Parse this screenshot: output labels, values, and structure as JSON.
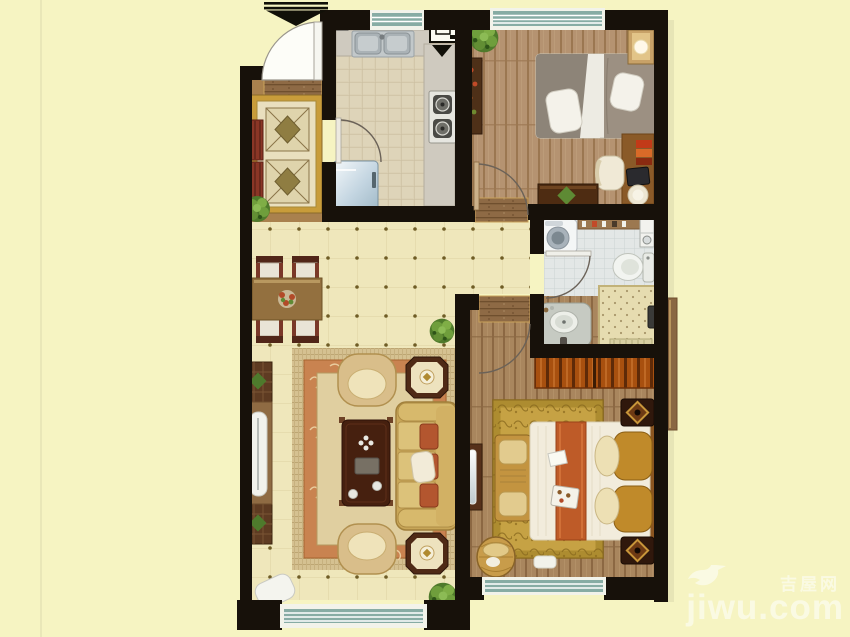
{
  "canvas": {
    "width": 850,
    "height": 637
  },
  "watermark": {
    "icon": "dove-bird-icon",
    "site_name_cn": "吉屋网",
    "logo_text": "jiwu.com"
  },
  "colors": {
    "bg": "#f6f4c2",
    "fold": "#e9e7b8",
    "wall": "#17110a",
    "glass": "#87aca4",
    "frame": "#f2f3ea",
    "tileLiving": "#efe7bb",
    "tileLivingLine": "#e1d5a6",
    "tileDot": "#6f5d26",
    "tileKitchen": "#dbd0b4",
    "tileKitchenLine": "#c8bc9e",
    "tileBath": "#e3e7e6",
    "tileBathLine": "#cbd3d3",
    "woodLight": "#b59371",
    "woodLightLine": "#9b7751",
    "woodMid": "#a9865e",
    "woodMidLine": "#8c6843",
    "thresh": "#8e6a45",
    "threshLine": "#6f4f2e",
    "counter": "#cfcabf",
    "steel": "#aab2b6",
    "fridge": "#c3d5e1",
    "rugGold": "#c6a244",
    "rugGoldBorder": "#ad8c30",
    "foyerRugBorder": "#c89c3a",
    "foyerRugField": "#e9dfbe",
    "fringe": "#d5c191",
    "rugOrange": "#c98350",
    "rugField": "#e0cfa0",
    "sofa": "#c8a658",
    "cushion": "#b3562f",
    "armchair": "#d9be8a",
    "woodFurn": "#8f6b43",
    "chairRed": "#7a3828",
    "wardrobe": "#a8500f",
    "bedWhite": "#f2ecdc",
    "runner": "#be5b28",
    "pillowGold": "#c08a2a",
    "plantGreen": "#4f7a2b",
    "wm": "#ffffff"
  },
  "floor_plan": {
    "style": "top-down rendered apartment floor plan, no text labels",
    "rooms": [
      {
        "name": "entry-foyer",
        "items": [
          "entrance-arrow-marker",
          "entry-door",
          "patterned-runner-rug",
          "shoe-cabinet-upper",
          "shoe-cabinet-lower",
          "potted-plant"
        ]
      },
      {
        "name": "kitchen",
        "items": [
          "window",
          "counter-top",
          "double-stainless-sink",
          "gas-meter-symbol",
          "flue-duct-symbol",
          "gas-stove-two-burners",
          "refrigerator",
          "kitchen-door"
        ]
      },
      {
        "name": "second-bedroom",
        "items": [
          "window",
          "potted-plant",
          "wall-shelf",
          "single-bed",
          "pillows",
          "corner-wardrobe-lamp",
          "desk",
          "books",
          "laptop",
          "stool",
          "chair",
          "low-table-with-plant",
          "room-door"
        ]
      },
      {
        "name": "bathroom",
        "items": [
          "washing-machine",
          "toiletry-shelf",
          "corner-washbasin-unit",
          "toilet",
          "vanity-sink",
          "shower-mat",
          "shower-fixture",
          "floor-drain",
          "bathroom-door"
        ]
      },
      {
        "name": "living-dining-room",
        "items": [
          "dining-table",
          "dining-chairs-x4",
          "flower-centerpiece",
          "tv-cabinet",
          "tv",
          "media-side-units",
          "area-rug",
          "armchair-north",
          "armchair-south",
          "coffee-table",
          "tea-set",
          "sofa-three-seat",
          "throw-pillow",
          "octagonal-lamp-table-north",
          "octagonal-lamp-table-south",
          "ottoman",
          "potted-plant-x2",
          "window"
        ]
      },
      {
        "name": "master-bedroom",
        "items": [
          "wardrobe",
          "double-bed",
          "bed-runner",
          "gold-pillows",
          "breakfast-tray",
          "foot-bench",
          "ornate-area-rug",
          "nightstand-x2",
          "dresser-with-mirror",
          "laundry-basket",
          "floor-mat",
          "window",
          "room-door"
        ]
      }
    ]
  }
}
